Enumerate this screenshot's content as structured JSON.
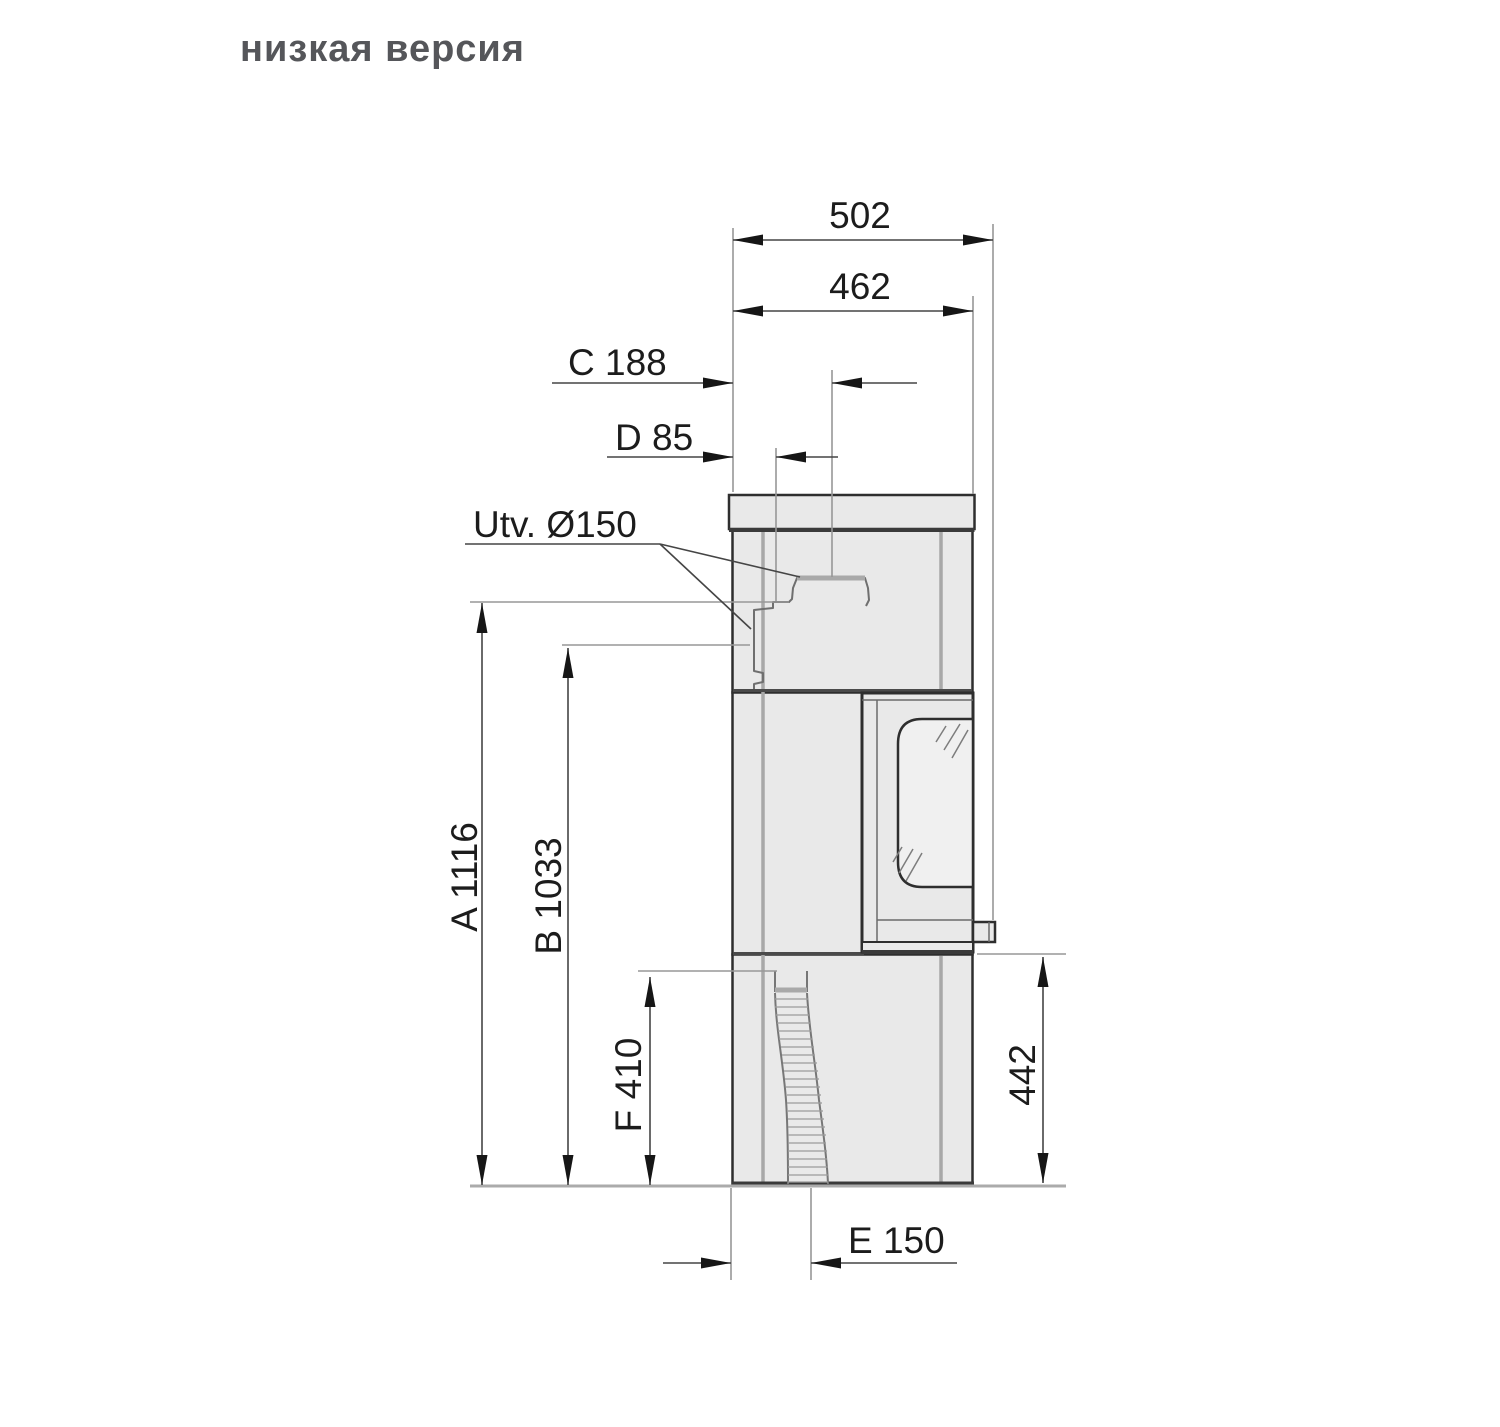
{
  "page": {
    "title": "низкая версия"
  },
  "drawing": {
    "dims": {
      "overall_depth": "502",
      "body_depth": "462",
      "top_flue_center_from_back": "C 188",
      "rear_flue_from_back": "D 85",
      "flue_outlet_diameter": "Utv. Ø150",
      "top_flue_height": "A 1116",
      "rear_flue_height": "B 1033",
      "side_connection_height": "F 410",
      "door_bottom_height": "442",
      "floor_outlet_from_back": "E 150"
    },
    "colors": {
      "body_fill": "#e9e9e9",
      "outline": "#2e2e2e",
      "dim_line": "#454545",
      "ext_line": "#979797",
      "title": "#55565a"
    }
  }
}
